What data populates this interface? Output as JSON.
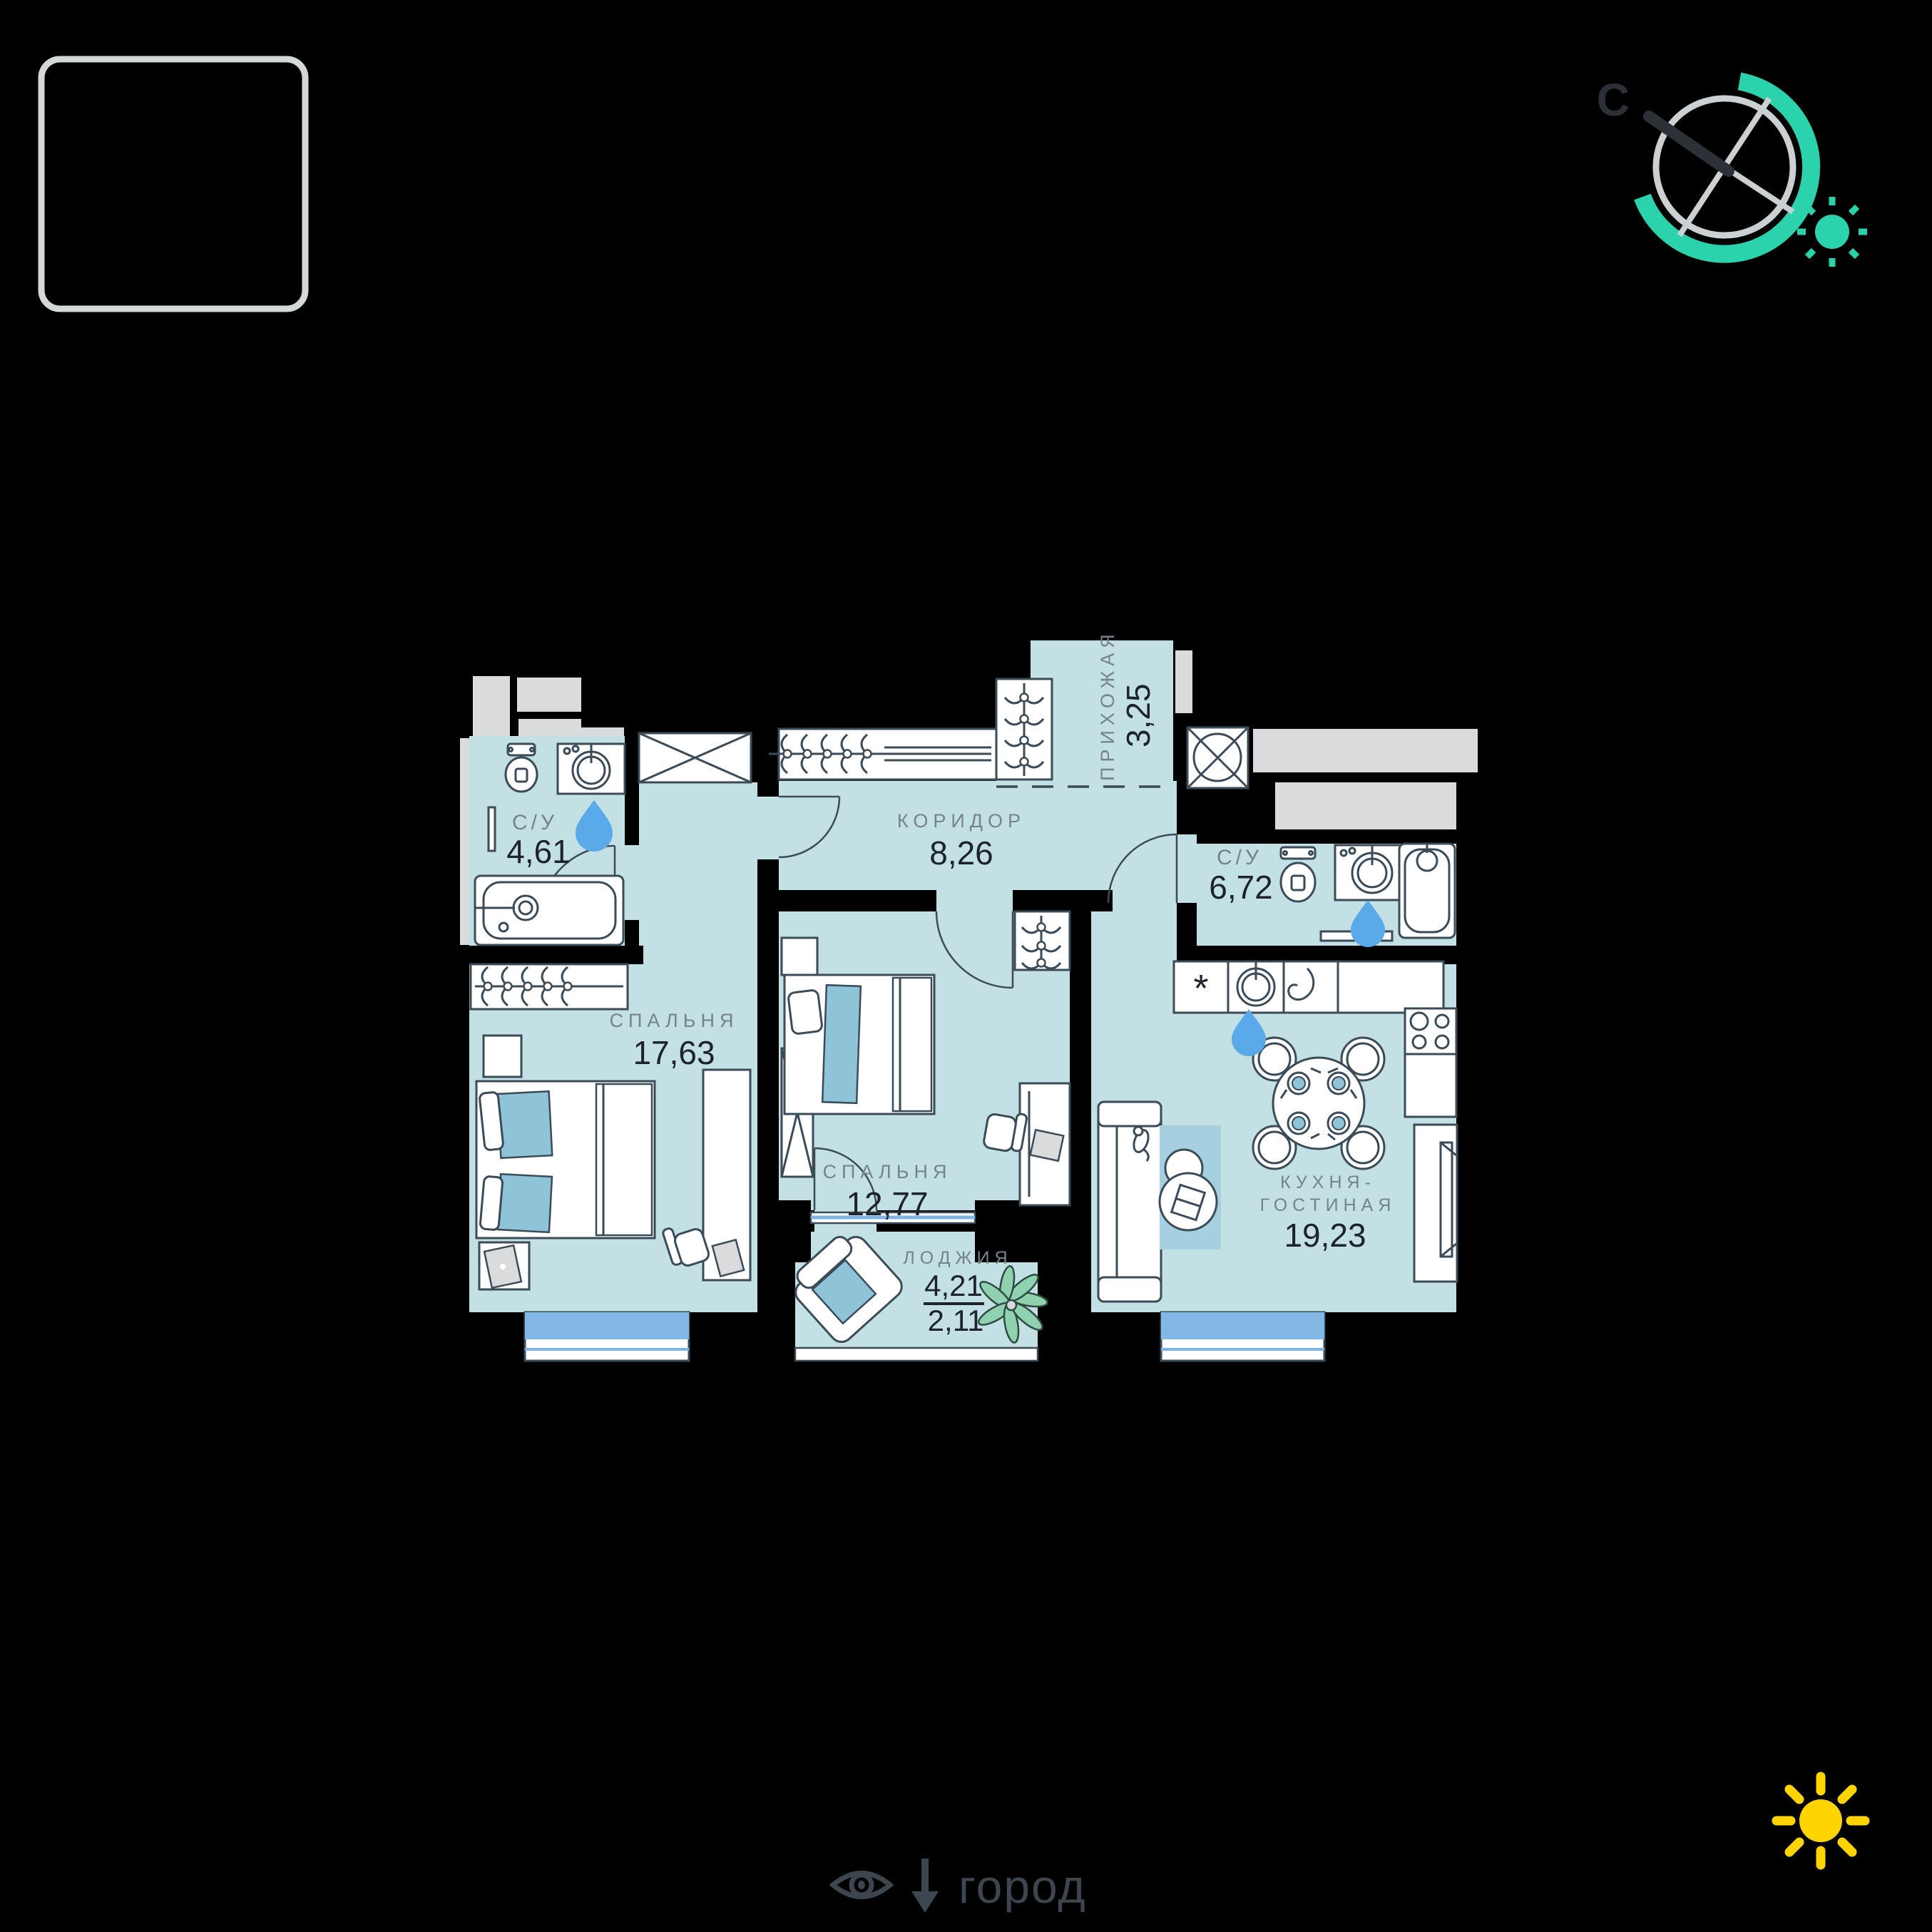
{
  "compass": {
    "north_label": "С"
  },
  "rooms": {
    "bath1": {
      "name": "С/У",
      "area": "4,61"
    },
    "corridor": {
      "name": "КОРИДОР",
      "area": "8,26"
    },
    "hall": {
      "name": "ПРИХОЖАЯ",
      "area": "3,25"
    },
    "bath2": {
      "name": "С/У",
      "area": "6,72"
    },
    "bedroom1": {
      "name": "СПАЛЬНЯ",
      "area": "17,63"
    },
    "bedroom2": {
      "name": "СПАЛЬНЯ",
      "area": "12,77"
    },
    "loggia": {
      "name": "ЛОДЖИЯ",
      "area_full": "4,21",
      "area_reduced": "2,11"
    },
    "kitchen": {
      "name_line1": "КУХНЯ-",
      "name_line2": "ГОСТИНАЯ",
      "area": "19,23"
    }
  },
  "kitchen_counter": {
    "asterisk": "*"
  },
  "footer": {
    "view_label": "город"
  },
  "icons": [
    "compass-icon",
    "sun-icon",
    "water-drop-icon",
    "eye-icon",
    "down-arrow-icon",
    "plant-icon"
  ],
  "colors": {
    "background": "#000000",
    "floor": "#c3e0e4",
    "accent_teal": "#2bd3ad",
    "sun_yellow": "#ffd400",
    "water_drop": "#5aa9e9",
    "furniture_line": "#3b4b57",
    "label_gray": "#74838c",
    "number_dark": "#1d2429",
    "outside_gray": "#d9dbdc",
    "window_glass": "#83b8e5",
    "textile_blue": "#8fc3d7",
    "rug_blue": "#a6cfe0"
  }
}
